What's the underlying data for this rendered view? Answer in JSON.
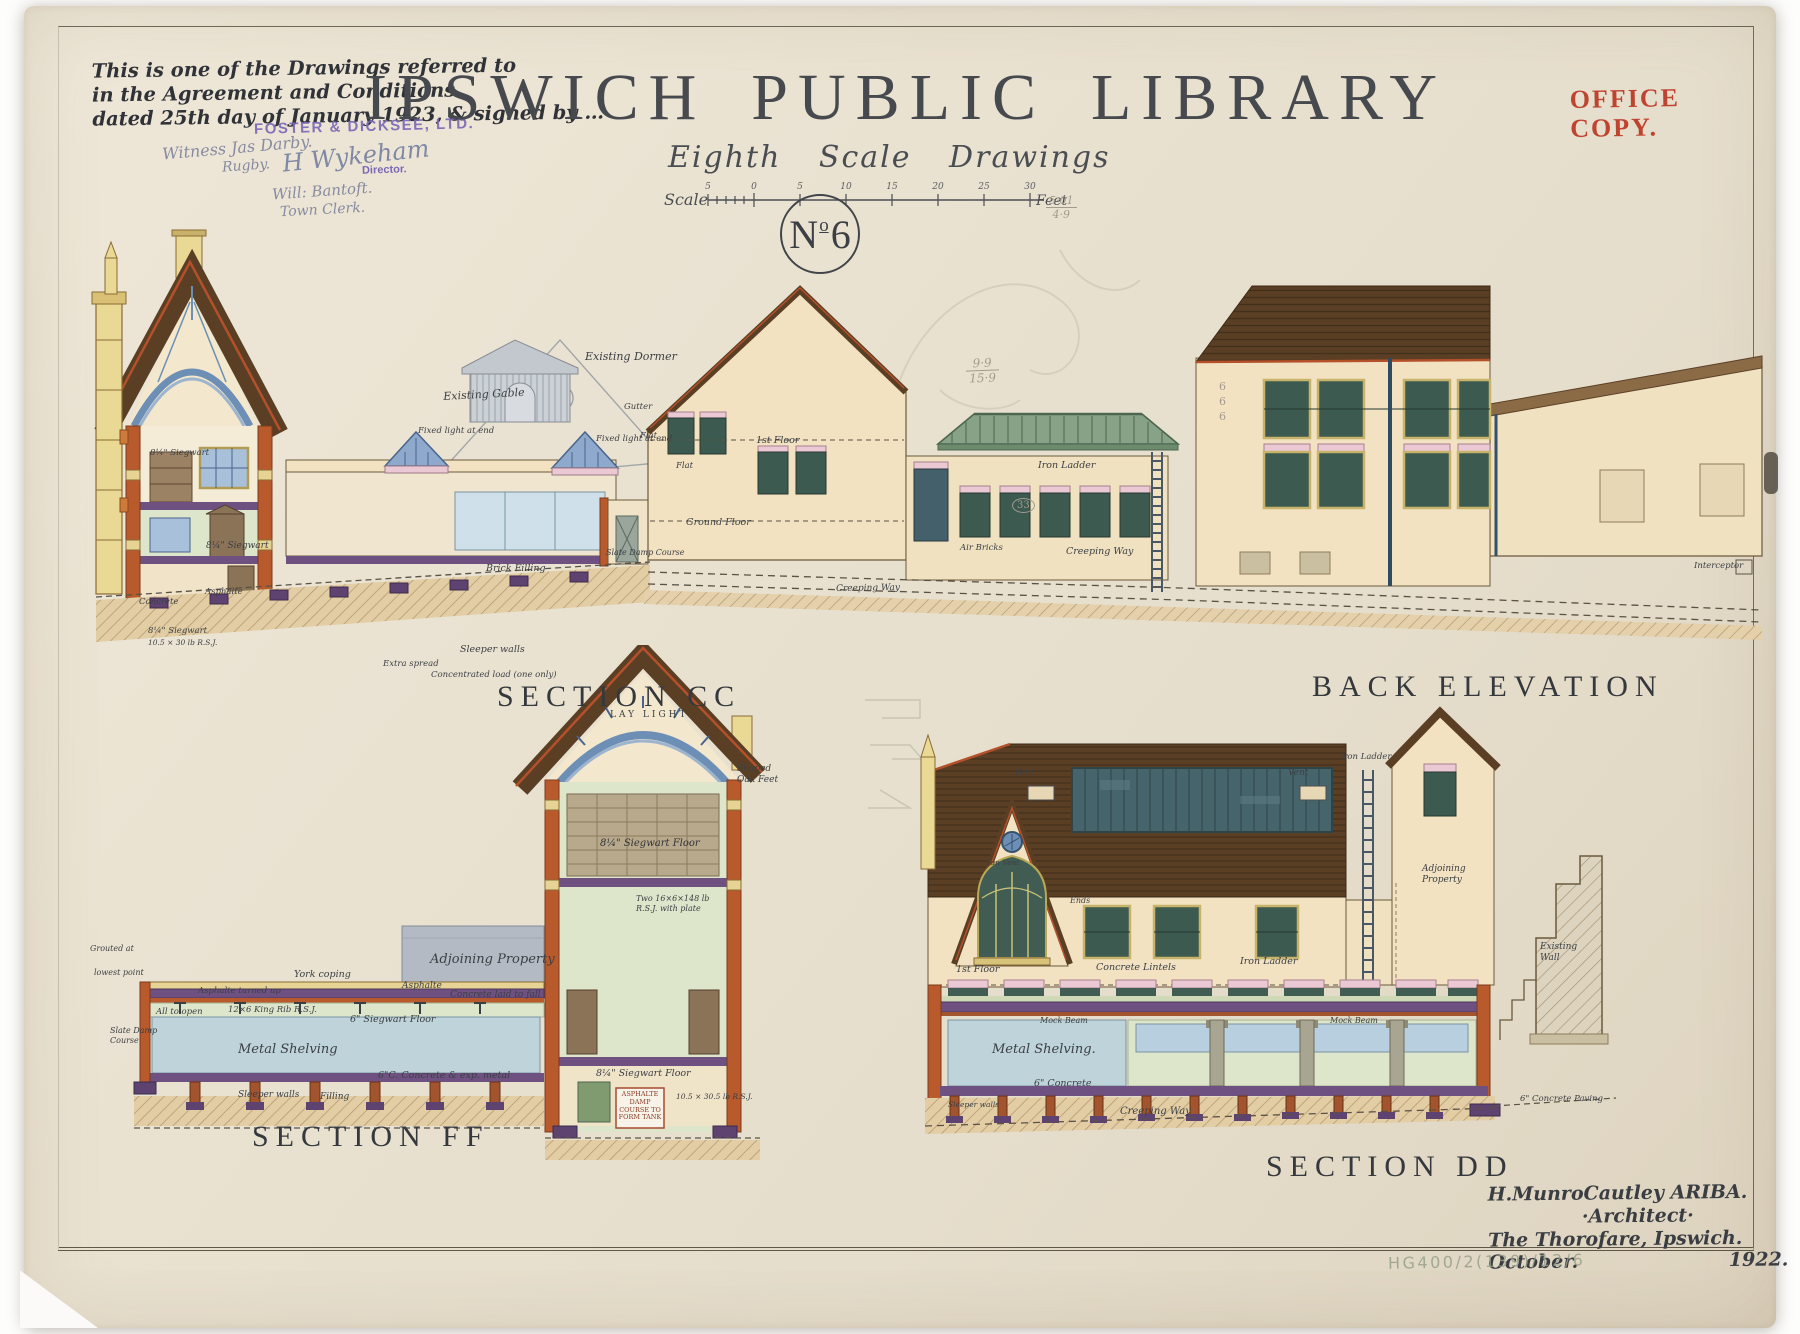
{
  "palette": {
    "paper": "#e9e1d0",
    "ink": "#3c4045",
    "title_ink": "#46494d",
    "red_stamp": "#bf4430",
    "purple_stamp": "#7b68b8",
    "pencil": "#a39a8d",
    "roof_brown": "#5a3f25",
    "wall_cream": "#f2e2c2",
    "cut_orange": "#b95a2d",
    "interior_green": "#dde5cb",
    "window_blue": "#8fa9cc",
    "glass_green": "#3d5a50",
    "skylight_teal": "#46646c",
    "lantern_green": "#87a287",
    "floor_purple": "#6f5181",
    "shelving_blue": "#bfd4da",
    "timber_yellow": "#ead995",
    "lintel_pink": "#eac9d4"
  },
  "header": {
    "note_line1": "This is one of the Drawings referred to",
    "note_line2": "in the Agreement and Conditions",
    "note_line3": "dated 25th day of January 1923, & signed by …",
    "stamp_contractor": "FOSTER & DICKSEE, LTD.",
    "stamp_director": "Director.",
    "sig_witness": "Witness Jas Darby.",
    "sig_witness2": "Rugby.",
    "sig_director": "H Wykeham",
    "sig_clerk": "Will: Bantoft.",
    "sig_clerk2": "Town Clerk.",
    "title_word1": "IPSWICH",
    "title_word2": "PUBLIC",
    "title_word3": "LIBRARY",
    "office_copy_line1": "OFFICE",
    "office_copy_line2": "COPY.",
    "subtitle": "Eighth Scale Drawings",
    "scale_label": "Scale",
    "feet_label": "Feet",
    "scale_ticks": [
      "5",
      "0",
      "5",
      "10",
      "15",
      "20",
      "25",
      "30"
    ],
    "sheet_no_n": "N",
    "sheet_no_o": "o",
    "sheet_no_digit": "6"
  },
  "captions": {
    "cc": "SECTION CC",
    "back": "BACK ELEVATION",
    "ff": "SECTION FF",
    "dd": "SECTION DD"
  },
  "architect": {
    "line1": "H.MunroCautley ARIBA.",
    "line2": "·Architect·",
    "line3": "The Thorofare, Ipswich.",
    "line4a": "October.",
    "line4b": "1922."
  },
  "ref_number": "HG400/2(139)/12/6",
  "pencil_notes": {
    "frac1_num": "9·9",
    "frac1_den": "15·9",
    "frac2_num": "5·01",
    "frac2_den": "4·9",
    "sixes": "666",
    "circled": "33"
  },
  "ann": {
    "cc": {
      "existing_dormer": "Existing Dormer",
      "existing_gable": "Existing Gable",
      "fixed_light_1": "Fixed light at end",
      "fixed_light_2": "Fixed light at end",
      "siegwart_upper": "8¼\" Siegwart",
      "siegwart_mid": "8¼\" Siegwart",
      "siegwart_lower": "8¼\" Siegwart",
      "rsj": "10.5 × 30 lb R.S.J.",
      "sleeper_walls": "Sleeper walls",
      "brick_filling": "Brick Filling",
      "extra_spread": "Extra spread",
      "concentrated_load": "Concentrated load (one only)",
      "asphalte": "Asphalte",
      "concrete": "Concrete",
      "slate_damp": "Slate Damp Course"
    },
    "back": {
      "gutter": "Gutter",
      "flat1": "Flat",
      "flat2": "Flat",
      "first_floor": "1st Floor",
      "ground_floor": "Ground Floor",
      "iron_ladder": "Iron Ladder",
      "air_bricks": "Air Bricks",
      "creeping_way": "Creeping Way",
      "creeping_way2": "Creeping Way",
      "interceptor": "Interceptor"
    },
    "ff": {
      "adjoining": "Adjoining Property",
      "york_coping": "York coping",
      "asphalte_turned": "Asphalte turned up",
      "asphalte": "Asphalte",
      "concrete_fall": "Concrete laid to fall",
      "all_open": "All to open",
      "king_rib": "12×6 King Rib R.S.J.",
      "siegwart6": "6\" Siegwart Floor",
      "metal_shelving": "Metal Shelving",
      "concrete_exp": "6\"C. Concrete & exp. metal",
      "sleeper": "Sleeper walls",
      "filling": "Filling",
      "slate_damp": "Slate Damp Course",
      "grouted": "Grouted at",
      "lowest": "lowest point",
      "lay_light": "LAY LIGHT",
      "siegwart_stack": "8¼\" Siegwart Floor",
      "rsj_two": "Two 16×6×148 lb R.S.J. with plate",
      "siegwart_floor": "8¼\" Siegwart Floor",
      "oak_feet": "Shaped Oak Feet",
      "rsj_small": "10.5 × 30.5 lb R.S.J.",
      "damp_tank": "Asphalte Damp Course to form tank"
    },
    "dd": {
      "vent1": "Vent",
      "vent2": "Vent",
      "fan_vent": "Fan Vent",
      "first_floor": "1st Floor",
      "ends": "Ends",
      "concrete_lintels": "Concrete Lintels",
      "iron_ladder1": "Iron Ladder",
      "iron_ladder2": "Iron Ladder",
      "mock_beam1": "Mock Beam",
      "mock_beam2": "Mock Beam",
      "metal_shelving": "Metal Shelving.",
      "concrete6": "6\" Concrete",
      "creeping_way": "Creeping Way",
      "sleeper": "Sleeper walls",
      "adjoining": "Adjoining Property",
      "existing_wall": "Existing Wall",
      "paving": "6\" Concrete Paving"
    }
  }
}
